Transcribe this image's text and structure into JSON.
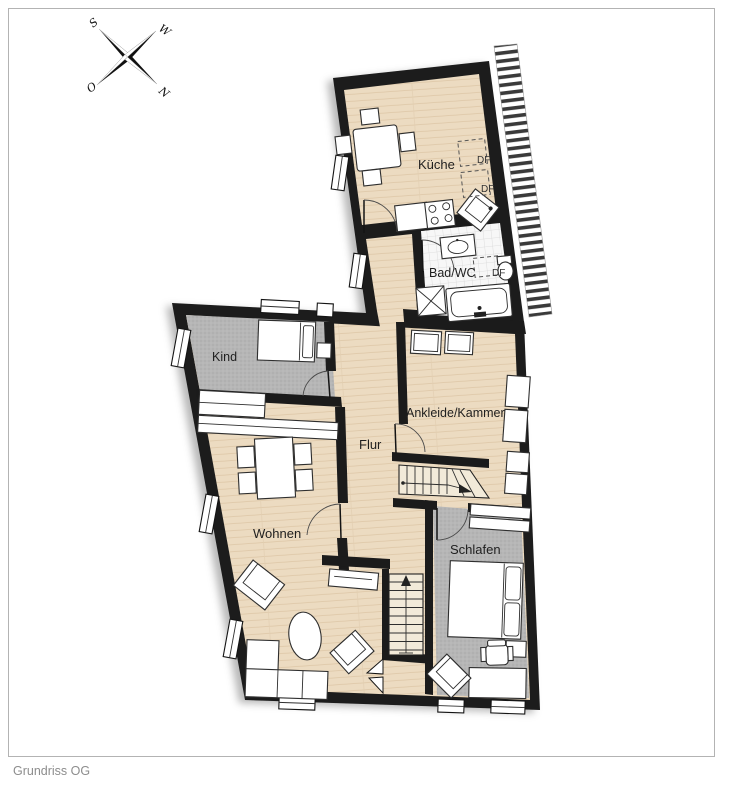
{
  "caption": "Grundriss OG",
  "compass": {
    "s": "S",
    "w": "W",
    "o": "O",
    "n": "N"
  },
  "rooms": {
    "kueche": "Küche",
    "bad": "Bad/WC",
    "kind": "Kind",
    "ankleide": "Ankleide/Kammer",
    "flur": "Flur",
    "wohnen": "Wohnen",
    "schlafen": "Schlafen"
  },
  "skylights": {
    "df1": "DF",
    "df2": "DF",
    "df3": "DF"
  },
  "colors": {
    "wall": "#1b1b1b",
    "wood": "#ecdbc1",
    "carpet": "#b6b6b6",
    "tile": "#f7f7f7",
    "label": "#1f1f1f",
    "caption": "#8d8d8d",
    "frame": "#b3b3b3"
  }
}
